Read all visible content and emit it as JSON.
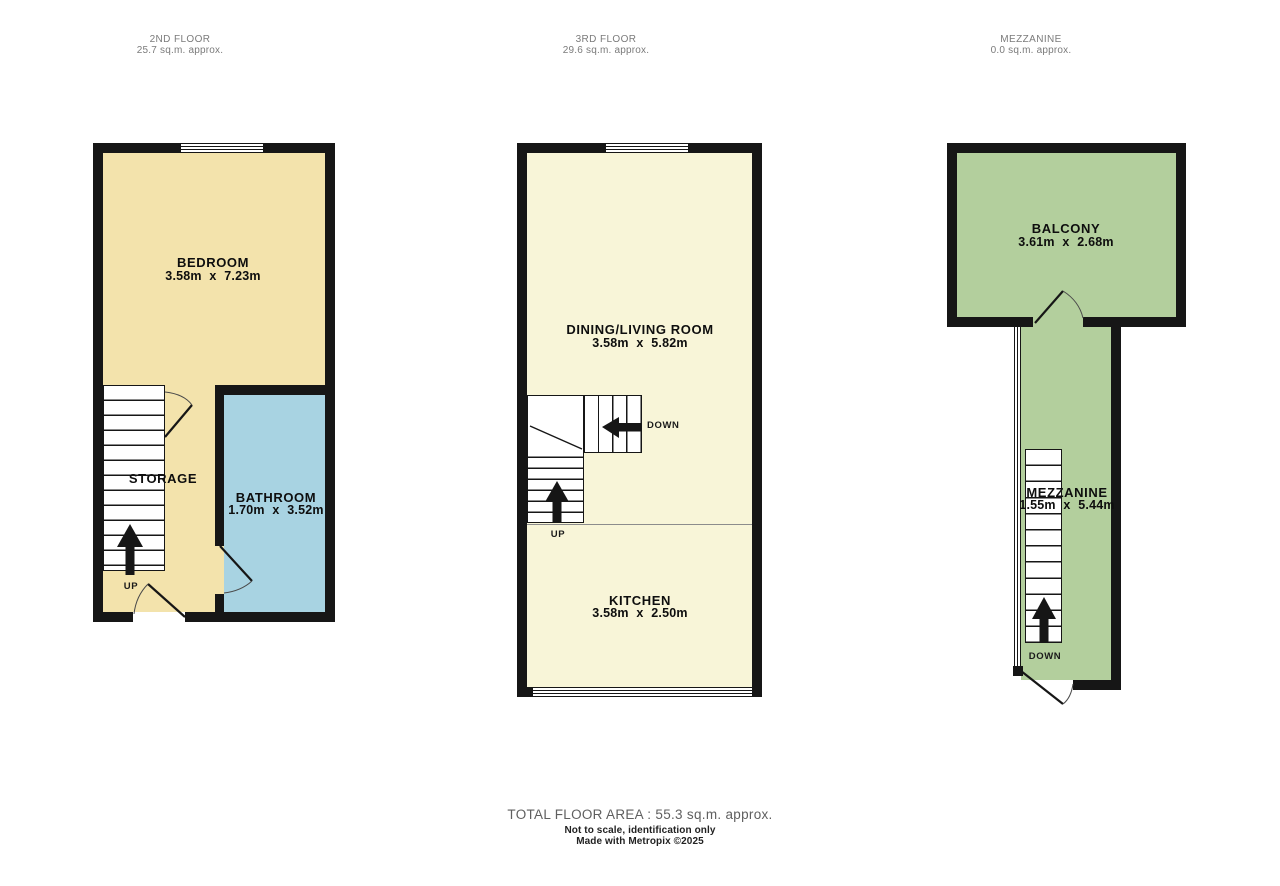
{
  "colors": {
    "wall": "#161616",
    "floor2_cream": "#f3e3ac",
    "floor3_pale_yellow": "#f8f5d8",
    "bathroom_blue": "#a8d3e2",
    "mezzanine_green": "#b3cf9d",
    "header_gray": "#7b7b7b",
    "footer_gray": "#5f5f5f"
  },
  "floors": [
    {
      "name": "2ND FLOOR",
      "area": "25.7 sq.m. approx.",
      "rooms": [
        {
          "label": "BEDROOM",
          "dims": "3.58m x 7.23m"
        },
        {
          "label": "BATHROOM",
          "dims": "1.70m x 3.52m"
        },
        {
          "label": "STORAGE"
        }
      ],
      "labels": {
        "up": "UP"
      }
    },
    {
      "name": "3RD FLOOR",
      "area": "29.6 sq.m. approx.",
      "rooms": [
        {
          "label": "DINING/LIVING ROOM",
          "dims": "3.58m x 5.82m"
        },
        {
          "label": "KITCHEN",
          "dims": "3.58m x 2.50m"
        }
      ],
      "labels": {
        "up": "UP",
        "down": "DOWN"
      }
    },
    {
      "name": "MEZZANINE",
      "area": "0.0 sq.m. approx.",
      "rooms": [
        {
          "label": "BALCONY",
          "dims": "3.61m x 2.68m"
        },
        {
          "label": "MEZZANINE",
          "dims": "1.55m x 5.44m"
        }
      ],
      "labels": {
        "down": "DOWN"
      }
    }
  ],
  "footer": {
    "total_area": "TOTAL FLOOR AREA : 55.3 sq.m. approx.",
    "disclaimer": "Not to scale, identification only",
    "credit": "Made with Metropix ©2025"
  }
}
